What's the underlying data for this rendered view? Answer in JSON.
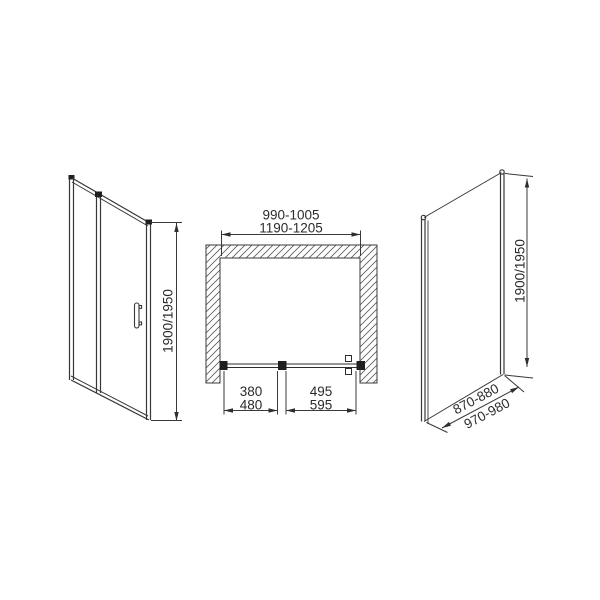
{
  "drawing": {
    "description": "shower enclosure dimensional drawing",
    "colors": {
      "line": "#383838",
      "profile_dark": "#1f1f1f",
      "text": "#2b2b2b",
      "background": "#ffffff"
    },
    "views": {
      "front_door": {
        "height_label": "1900/1950"
      },
      "plan": {
        "inner_width_label": "990-1005",
        "outer_width_label": "1190-1205",
        "left_segment": {
          "top": "380",
          "bottom": "480"
        },
        "right_segment": {
          "top": "495",
          "bottom": "595"
        }
      },
      "side_panel": {
        "height_label": "1900/1950",
        "width_min_label": "870-880",
        "width_max_label": "970-980"
      }
    }
  }
}
